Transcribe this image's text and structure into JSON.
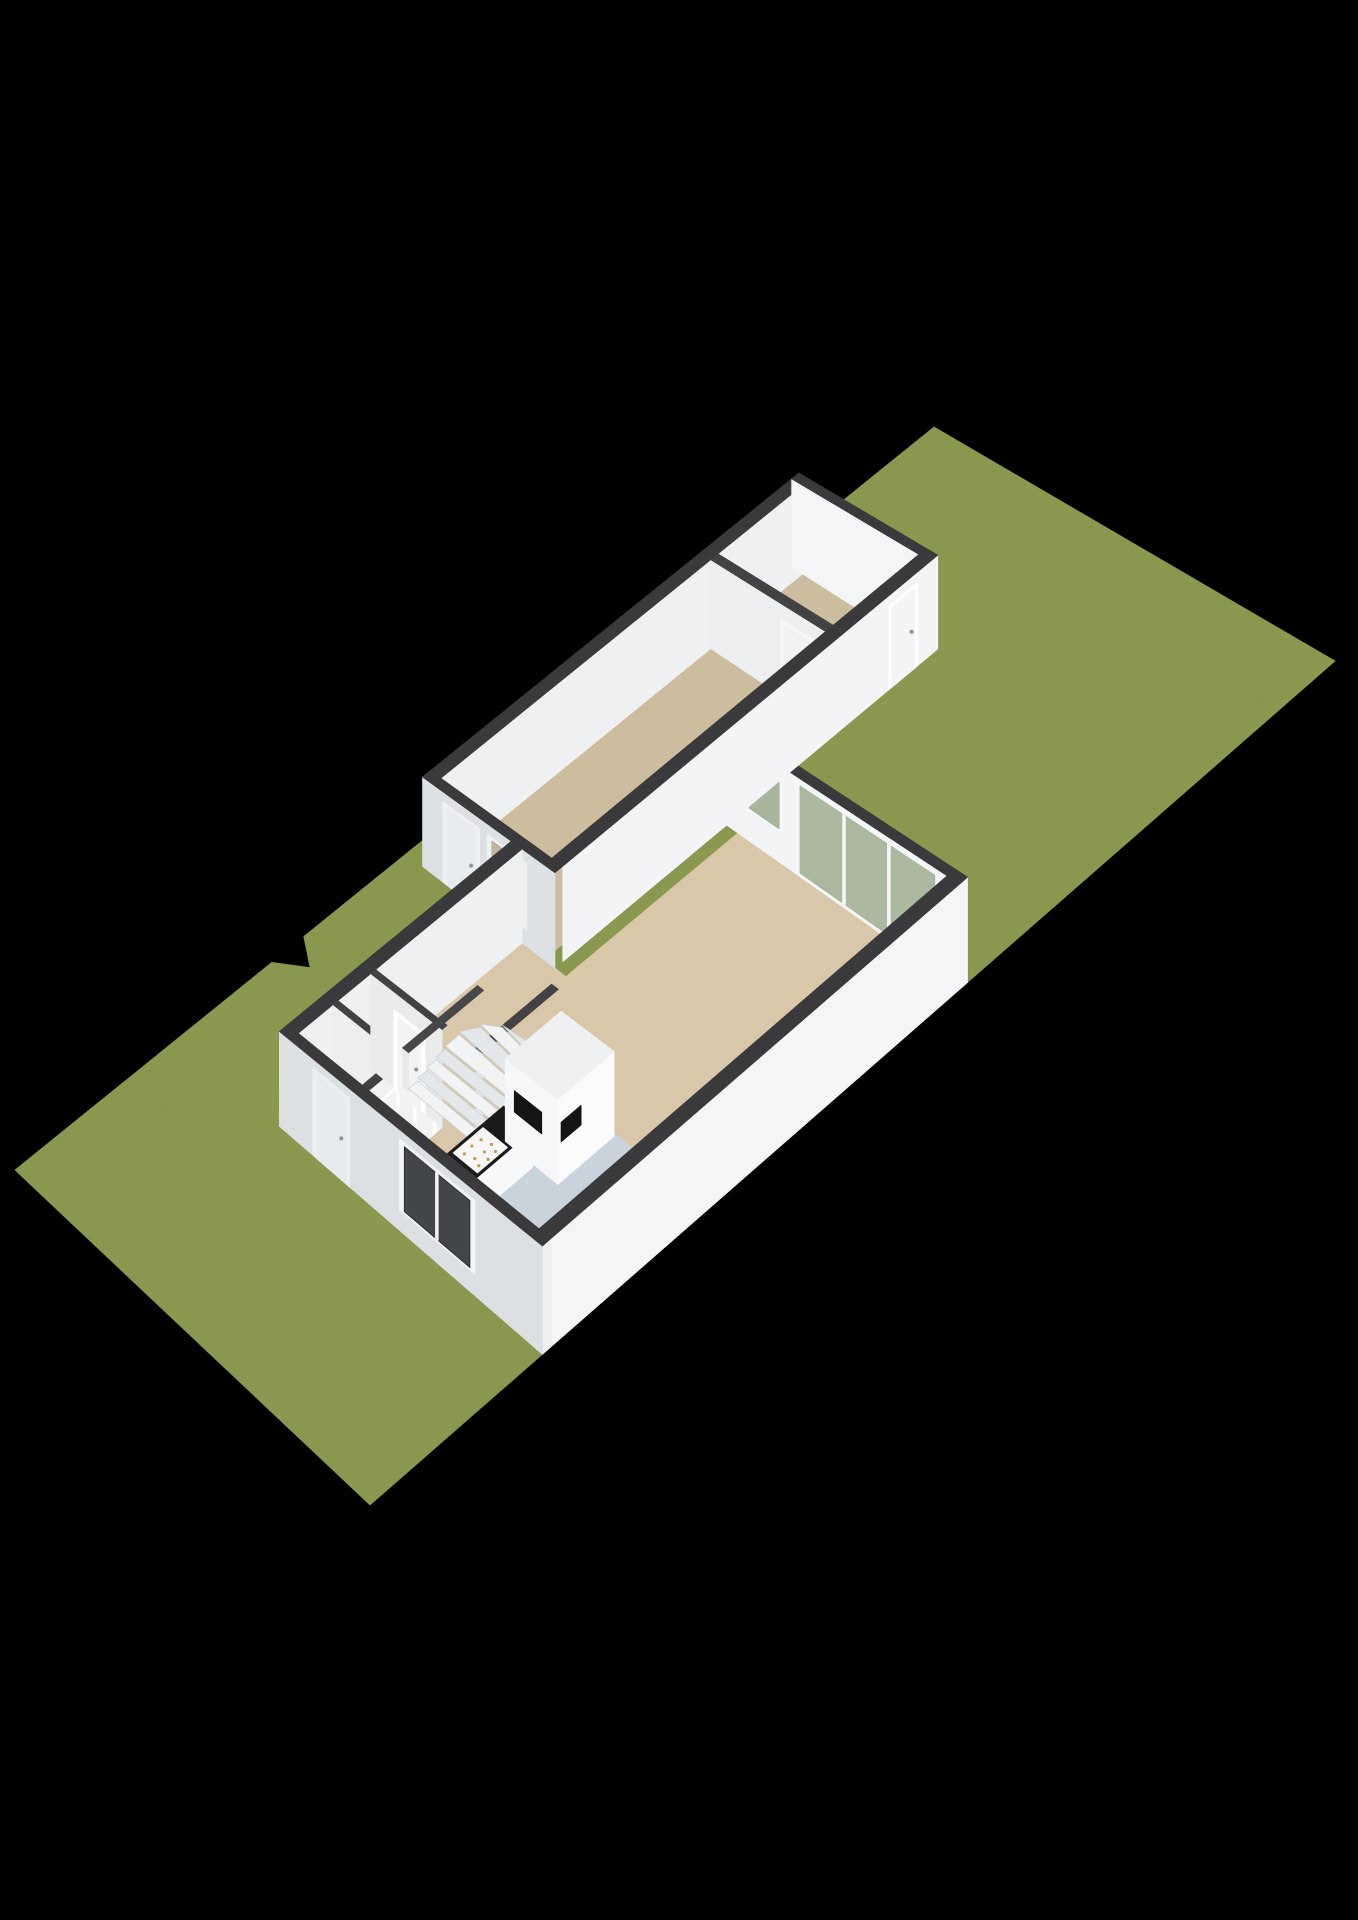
{
  "canvas": {
    "width": 1358,
    "height": 1920,
    "background": "#000000"
  },
  "projection": {
    "pairs": [
      {
        "s": [
          30,
          0
        ],
        "d": [
          934,
          427
        ]
      },
      {
        "s": [
          30,
          8.4
        ],
        "d": [
          1335,
          661
        ]
      },
      {
        "s": [
          0,
          0
        ],
        "d": [
          15,
          1170
        ]
      },
      {
        "s": [
          0,
          8.4
        ],
        "d": [
          370,
          1505
        ]
      }
    ],
    "height_factor": 0.66
  },
  "palette": {
    "background": "#000000",
    "grass": "#87964a",
    "grass_speckle_r": 0.33,
    "grass_speckle_g": 0.4,
    "grass_speckle_b": 0.16,
    "wall_cap": "#3a3a3c",
    "floor_beige": "#d8c7a8",
    "floor_rear": "#cdbd9f",
    "floor_kitchen": "#c9d3dd",
    "counter_top": "#1b1b1d"
  },
  "elements": [
    {
      "type": "ground",
      "name": "garden-lawn",
      "fill": "#87964a",
      "textured": true,
      "pts": [
        [
          0,
          0
        ],
        [
          7.8,
          0
        ],
        [
          8.3,
          0.55
        ],
        [
          8.8,
          0
        ],
        [
          30,
          0
        ],
        [
          30,
          8.4
        ],
        [
          0,
          8.4
        ]
      ]
    },
    {
      "type": "floor",
      "name": "rear-long-room-floor",
      "fill": "#cdbd9f",
      "pts": [
        [
          12.3,
          0.65
        ],
        [
          21.2,
          0.65
        ],
        [
          21.2,
          3.25
        ],
        [
          12.3,
          3.25
        ]
      ]
    },
    {
      "type": "floor",
      "name": "rear-small-room-floor",
      "fill": "#cdbd9f",
      "pts": [
        [
          21.45,
          0.65
        ],
        [
          24.35,
          0.65
        ],
        [
          24.35,
          3.25
        ],
        [
          21.45,
          3.25
        ]
      ]
    },
    {
      "type": "floor",
      "name": "hall-living-room-floor",
      "fill": "#d8c7a8",
      "pts": [
        [
          5.15,
          2.75
        ],
        [
          12.05,
          2.75
        ],
        [
          12.05,
          3.75
        ],
        [
          17.55,
          3.75
        ],
        [
          17.55,
          8.15
        ],
        [
          5.15,
          8.15
        ]
      ]
    },
    {
      "type": "floor",
      "name": "kitchen-floor",
      "fill": "#c9d3dd",
      "pts": [
        [
          5.15,
          5.2
        ],
        [
          9.8,
          5.2
        ],
        [
          9.8,
          8.15
        ],
        [
          5.15,
          8.15
        ]
      ]
    },
    {
      "type": "wall",
      "name": "rear-block-left-wall",
      "a1": 12.05,
      "b1": 0.4,
      "a2": 24.6,
      "b2": 0.65,
      "h": 2.6,
      "cap": "#3a3a3c",
      "faces": [
        {
          "side": "+B",
          "fill": "#eef0f1"
        }
      ]
    },
    {
      "type": "wall",
      "name": "rear-block-back-wall",
      "a1": 24.35,
      "b1": 0.4,
      "a2": 24.6,
      "b2": 3.5,
      "h": 2.6,
      "cap": "#3a3a3c",
      "faces": [
        {
          "side": "-A",
          "fill": "#f4f5f6"
        }
      ]
    },
    {
      "type": "wall",
      "name": "rear-rooms-divider-wall",
      "a1": 21.2,
      "b1": 0.65,
      "a2": 21.45,
      "b2": 3.25,
      "h": 2.6,
      "cap": "#424244",
      "faces": [
        {
          "side": "-A",
          "fill": "#eceef0",
          "openings": [
            {
              "kind": "door",
              "from": 2.3,
              "to": 3.0,
              "z0": 0,
              "z1": 2.1,
              "frame": "#f6f7f8",
              "leaf": "#f0f2f3"
            }
          ]
        }
      ]
    },
    {
      "type": "wall",
      "name": "living-room-garden-wall",
      "a1": 17.55,
      "b1": 3.5,
      "a2": 17.8,
      "b2": 8.4,
      "h": 2.6,
      "cap": "#3a3a3c",
      "faces": [
        {
          "side": "-A",
          "fill": "#f2f4f5",
          "openings": [
            {
              "kind": "window",
              "from": 3.95,
              "to": 4.7,
              "z0": 0.85,
              "z1": 2.45,
              "frame": "#f4f6f7",
              "glass": "#9fae91",
              "opacity": 0.9,
              "panes": 1
            },
            {
              "kind": "window",
              "from": 5.05,
              "to": 7.95,
              "z0": 0.06,
              "z1": 2.45,
              "frame": "#f4f6f7",
              "glass": "#a3b296",
              "opacity": 0.9,
              "panes": 3
            }
          ]
        }
      ]
    },
    {
      "type": "wall",
      "name": "rear-block-right-wall",
      "a1": 12.3,
      "b1": 3.25,
      "a2": 24.6,
      "b2": 3.5,
      "h": 2.6,
      "cap": "#3a3a3c",
      "faces": [
        {
          "side": "+B",
          "fill": "#f3f4f6",
          "openings": [
            {
              "kind": "door",
              "from": 23.0,
              "to": 23.85,
              "z0": 0,
              "z1": 2.25,
              "frame": "#ffffff",
              "leaf": "#f2f4f5"
            }
          ]
        }
      ]
    },
    {
      "type": "wall",
      "name": "rear-block-front-wall",
      "a1": 12.05,
      "b1": 0.4,
      "a2": 12.3,
      "b2": 3.5,
      "h": 2.6,
      "cap": "#3a3a3c",
      "faces": [
        {
          "side": "-A",
          "fill": "#dde1e3",
          "openings": [
            {
              "kind": "door",
              "from": 0.95,
              "to": 1.7,
              "z0": 0,
              "z1": 2.25,
              "frame": "#eef0f2",
              "leaf": "#e9ecee"
            },
            {
              "kind": "window",
              "from": 2.0,
              "to": 2.8,
              "z0": 0.5,
              "z1": 2.25,
              "frame": "#eef0f2",
              "glass": "#b9ab90",
              "opacity": 0.85,
              "panes": 1
            }
          ]
        }
      ]
    },
    {
      "type": "wall",
      "name": "front-block-left-wall",
      "a1": 4.9,
      "b1": 2.5,
      "a2": 12.05,
      "b2": 2.75,
      "h": 2.6,
      "cap": "#3a3a3c",
      "faces": [
        {
          "side": "+B",
          "fill": "#eef0f1"
        }
      ]
    },
    {
      "type": "wall",
      "name": "closet-toilet-divider-wall",
      "a1": 6.2,
      "b1": 2.75,
      "a2": 6.35,
      "b2": 4.25,
      "h": 2.6,
      "cap": "#424244",
      "faces": [
        {
          "side": "-A",
          "fill": "#eceef0"
        }
      ]
    },
    {
      "type": "wall",
      "name": "toilet-hall-wall",
      "a1": 5.15,
      "b1": 4.25,
      "a2": 7.35,
      "b2": 4.4,
      "h": 2.6,
      "cap": "#424244",
      "faces": [
        {
          "side": "-A",
          "fill": "#e8eaec"
        },
        {
          "side": "+B",
          "fill": "#f0f2f3",
          "openings": [
            {
              "kind": "door",
              "from": 5.45,
              "to": 6.0,
              "z0": 0,
              "z1": 2.05,
              "frame": "#ffffff",
              "leaf": "#f2f3f4"
            },
            {
              "kind": "door",
              "from": 6.55,
              "to": 7.1,
              "z0": 0,
              "z1": 2.05,
              "frame": "#ffffff",
              "leaf": "#f2f3f4"
            }
          ]
        }
      ]
    },
    {
      "type": "wall",
      "name": "hall-stair-wall",
      "a1": 7.35,
      "b1": 2.75,
      "a2": 7.5,
      "b2": 4.4,
      "h": 2.6,
      "cap": "#424244",
      "faces": [
        {
          "side": "-A",
          "fill": "#e9ebed",
          "openings": [
            {
              "kind": "door",
              "from": 3.35,
              "to": 3.95,
              "z0": 0,
              "z1": 2.05,
              "frame": "#ffffff",
              "leaf": "#f1f3f4"
            }
          ]
        }
      ]
    },
    {
      "type": "wall",
      "name": "stairwell-kitchen-wall",
      "a1": 7.5,
      "b1": 5.05,
      "a2": 9.8,
      "b2": 5.2,
      "h": 2.6,
      "cap": "#424244",
      "faces": [
        {
          "side": "-A",
          "fill": "#e9ebed"
        }
      ]
    },
    {
      "type": "wall",
      "name": "stair-stringer",
      "a1": 7.5,
      "b1": 3.38,
      "a2": 9.8,
      "b2": 3.52,
      "h": 1.05,
      "cap": "#47474a",
      "faces": [
        {
          "side": "-A",
          "fill": "#e6e8ea"
        }
      ]
    },
    {
      "type": "treads",
      "name": "staircase",
      "fill1": "#f2f3f4",
      "fill2": "#e4e7e9",
      "edge": "#c9cdd1",
      "quads": [
        {
          "z": 0.08,
          "pts": [
            [
              7.5,
              3.52
            ],
            [
              7.5,
              5.05
            ],
            [
              7.78,
              5.05
            ],
            [
              7.78,
              3.52
            ]
          ]
        },
        {
          "z": 0.16,
          "pts": [
            [
              7.78,
              3.52
            ],
            [
              7.78,
              5.05
            ],
            [
              8.06,
              5.05
            ],
            [
              8.06,
              3.52
            ]
          ]
        },
        {
          "z": 0.24,
          "pts": [
            [
              8.06,
              3.52
            ],
            [
              8.06,
              5.05
            ],
            [
              8.34,
              5.05
            ],
            [
              8.34,
              3.52
            ]
          ]
        },
        {
          "z": 0.32,
          "pts": [
            [
              8.34,
              3.52
            ],
            [
              8.34,
              5.05
            ],
            [
              8.62,
              5.05
            ],
            [
              8.62,
              3.52
            ]
          ]
        },
        {
          "z": 0.4,
          "pts": [
            [
              8.62,
              3.52
            ],
            [
              8.62,
              5.05
            ],
            [
              8.95,
              5.05
            ],
            [
              9.05,
              3.52
            ]
          ]
        },
        {
          "z": 0.48,
          "pts": [
            [
              9.05,
              3.52
            ],
            [
              8.95,
              5.05
            ],
            [
              9.28,
              5.0
            ],
            [
              9.45,
              3.7
            ]
          ]
        },
        {
          "z": 0.56,
          "pts": [
            [
              9.45,
              3.7
            ],
            [
              9.28,
              5.0
            ],
            [
              9.55,
              4.95
            ],
            [
              9.72,
              4.0
            ]
          ]
        },
        {
          "z": 0.62,
          "pts": [
            [
              9.72,
              4.0
            ],
            [
              9.55,
              4.95
            ],
            [
              9.75,
              5.0
            ],
            [
              9.78,
              4.45
            ]
          ]
        },
        {
          "z": 0.68,
          "pts": [
            [
              9.78,
              4.45
            ],
            [
              9.75,
              5.0
            ],
            [
              9.8,
              5.05
            ],
            [
              9.8,
              4.6
            ]
          ]
        }
      ]
    },
    {
      "type": "box",
      "name": "kitchen-counter",
      "a1": 5.85,
      "b1": 5.3,
      "a2": 8.0,
      "b2": 5.95,
      "h": 0.95,
      "cap": "#1b1b1d",
      "faces": [
        {
          "side": "-A",
          "fill": "#f4f5f6"
        },
        {
          "side": "+B",
          "fill": "#f7f8f9"
        }
      ]
    },
    {
      "type": "plate",
      "name": "cooktop",
      "z": 0.96,
      "fill": "#f6f6f4",
      "dotFill": "#c09a50",
      "dotR": 1.6,
      "pts": [
        [
          6.4,
          5.36
        ],
        [
          7.3,
          5.36
        ],
        [
          7.3,
          5.9
        ],
        [
          6.4,
          5.9
        ]
      ],
      "dots": [
        [
          6.55,
          5.5
        ],
        [
          6.8,
          5.48
        ],
        [
          7.05,
          5.5
        ],
        [
          6.62,
          5.68
        ],
        [
          6.88,
          5.7
        ],
        [
          7.12,
          5.68
        ],
        [
          6.55,
          5.82
        ],
        [
          6.8,
          5.84
        ],
        [
          7.05,
          5.82
        ]
      ]
    },
    {
      "type": "box",
      "name": "kitchen-tall-cabinets",
      "a1": 8.05,
      "b1": 5.3,
      "a2": 9.75,
      "b2": 6.45,
      "h": 2.15,
      "cap": "#eef0f1",
      "faces": [
        {
          "side": "-A",
          "fill": "#f6f7f8",
          "openings": [
            {
              "kind": "niche",
              "from": 5.5,
              "to": 6.1,
              "z0": 0.95,
              "z1": 1.5,
              "glass": "#141416",
              "opacity": 1
            }
          ]
        },
        {
          "side": "+B",
          "fill": "#fbfbfc",
          "openings": [
            {
              "kind": "niche",
              "from": 8.15,
              "to": 8.75,
              "z0": 1.0,
              "z1": 1.5,
              "glass": "#151517",
              "opacity": 1
            }
          ]
        }
      ]
    },
    {
      "type": "wall",
      "name": "house-right-wall",
      "a1": 4.9,
      "b1": 8.15,
      "a2": 17.8,
      "b2": 8.4,
      "h": 2.6,
      "cap": "#3a3a3c",
      "faces": [
        {
          "side": "+B",
          "fill": "#f4f5f7"
        },
        {
          "side": "-A",
          "fill": "#e2e5e7"
        }
      ]
    },
    {
      "type": "wall",
      "name": "front-wall",
      "a1": 4.9,
      "b1": 2.5,
      "a2": 5.15,
      "b2": 8.4,
      "h": 2.6,
      "cap": "#3a3a3c",
      "faces": [
        {
          "side": "+B",
          "fill": "#eef0f2"
        },
        {
          "side": "-A",
          "fill": "#dce0e2",
          "openings": [
            {
              "kind": "door",
              "from": 3.35,
              "to": 4.1,
              "z0": 0,
              "z1": 2.3,
              "frame": "#eceff0",
              "leaf": "#e8ebed"
            },
            {
              "kind": "window",
              "from": 5.35,
              "to": 6.9,
              "z0": 0.55,
              "z1": 2.3,
              "frame": "#f2f4f5",
              "glass": "#23262b",
              "opacity": 0.85,
              "panes": 2
            }
          ]
        }
      ]
    }
  ]
}
